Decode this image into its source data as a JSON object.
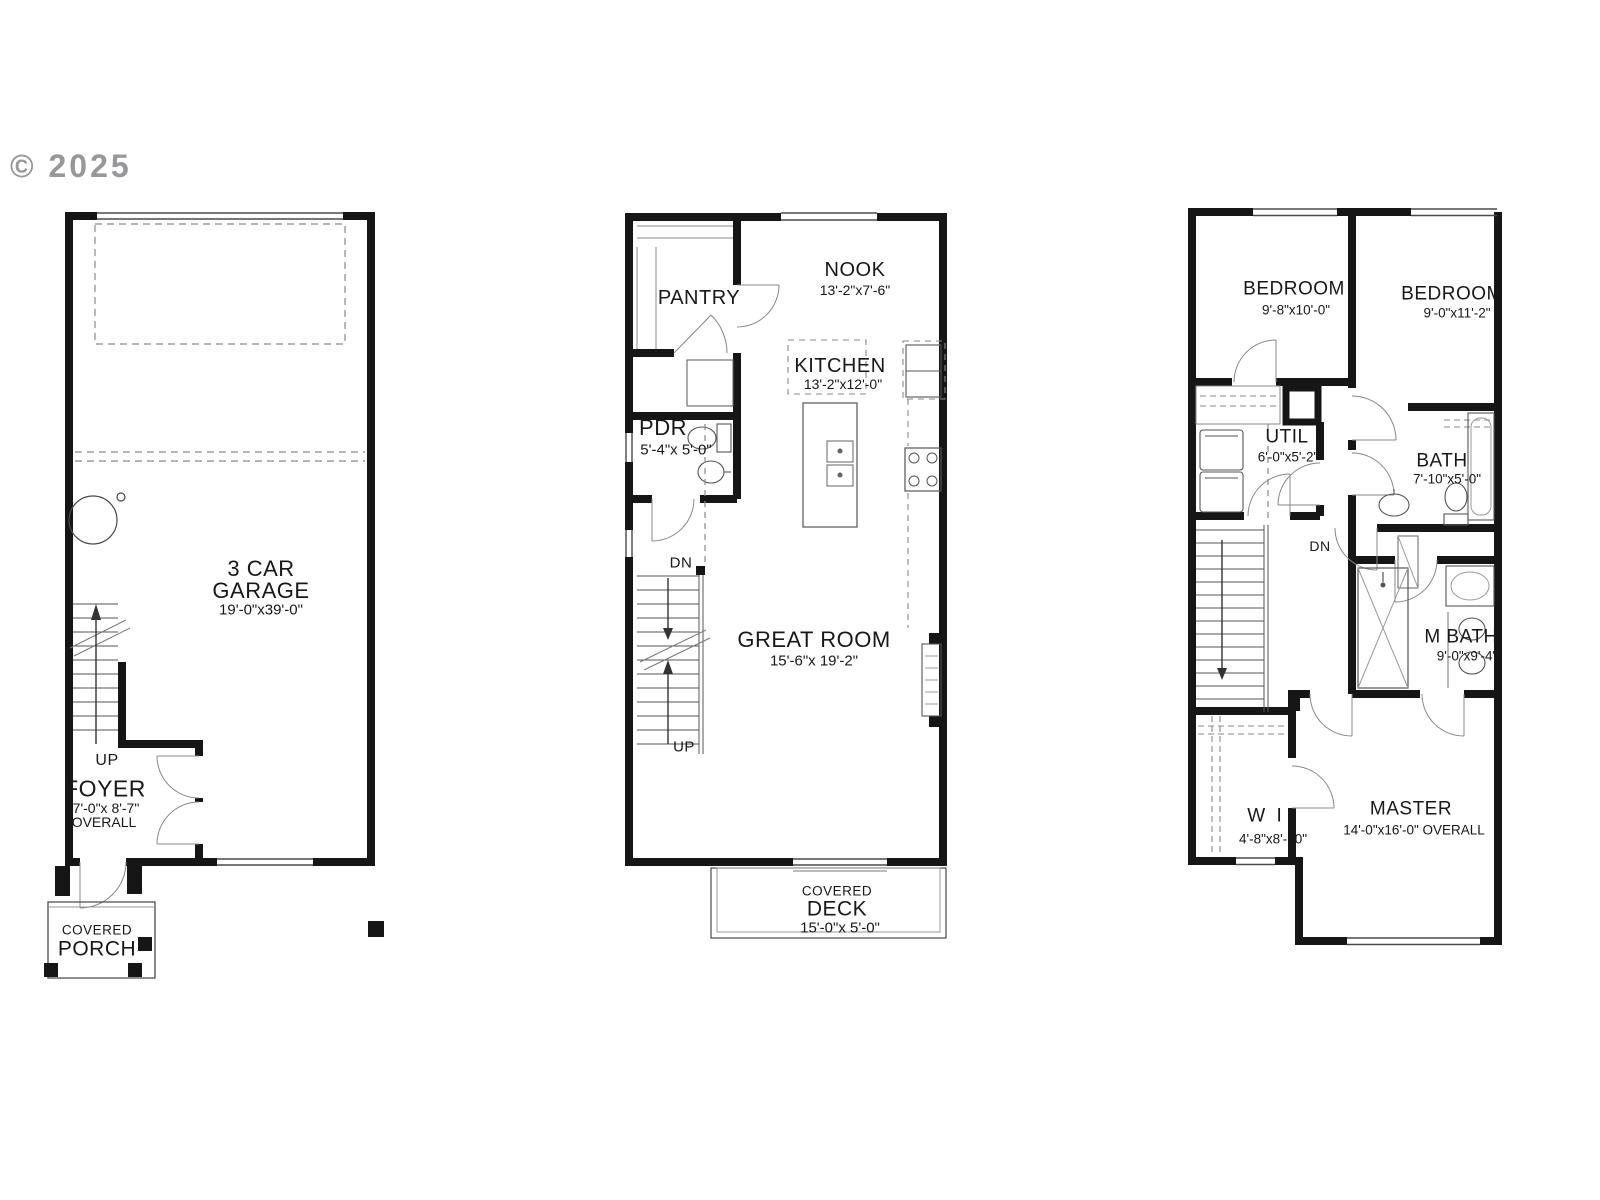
{
  "copyright": "© 2025",
  "floor1": {
    "garage_line1": "3 CAR",
    "garage_line2": "GARAGE",
    "garage_dims": "19'-0\"x39'-0\"",
    "up_label": "UP",
    "foyer": "FOYER",
    "foyer_dims": "7'-0\"x 8'-7\"",
    "foyer_overall": "OVERALL",
    "porch_line1": "COVERED",
    "porch_line2": "PORCH"
  },
  "floor2": {
    "pantry": "PANTRY",
    "nook": "NOOK",
    "nook_dims": "13'-2\"x7'-6\"",
    "kitchen": "KITCHEN",
    "kitchen_dims": "13'-2\"x12'-0\"",
    "pdr": "PDR",
    "pdr_dims": "5'-4\"x 5'-0\"",
    "dn_label": "DN",
    "great_room": "GREAT ROOM",
    "great_room_dims": "15'-6\"x 19'-2\"",
    "up_label": "UP",
    "deck_line1": "COVERED",
    "deck_line2": "DECK",
    "deck_dims": "15'-0\"x 5'-0\""
  },
  "floor3": {
    "bedroom1": "BEDROOM",
    "bedroom1_dims": "9'-8\"x10'-0\"",
    "bedroom2": "BEDROOM",
    "bedroom2_dims": "9'-0\"x11'-2\"",
    "util": "UTIL",
    "util_dims": "6'-0\"x5'-2\"",
    "bath": "BATH",
    "bath_dims": "7'-10\"x5'-0\"",
    "dn_label": "DN",
    "mbath": "M BATH",
    "mbath_dims": "9'-0\"x9'-4\"",
    "wi": "W I",
    "wi_dims": "4'-8\"x8'-10\"",
    "master": "MASTER",
    "master_dims": "14'-0\"x16'-0\" OVERALL"
  },
  "colors": {
    "wall": "#161616",
    "thin": "#4a4a4a",
    "light": "#8a8a8a",
    "text": "#181818"
  }
}
